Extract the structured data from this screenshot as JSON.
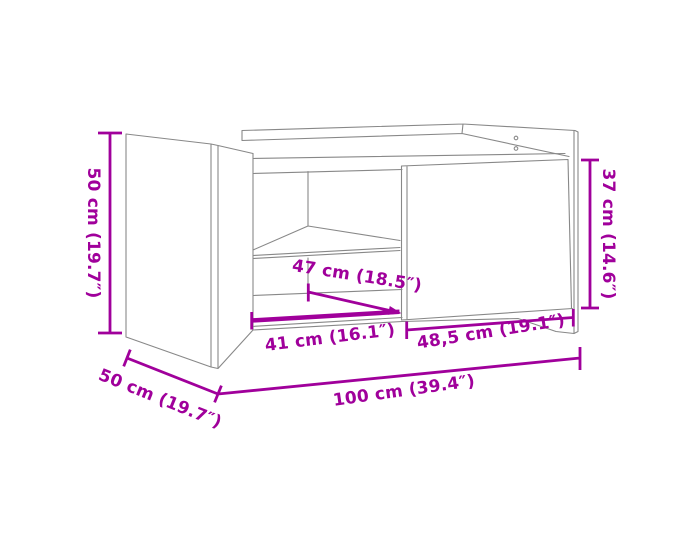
{
  "page": {
    "background_color": "#ffffff",
    "type": "product-dimension-diagram",
    "product": "coffee table line drawing"
  },
  "diagram": {
    "accent_color": "#A0009B",
    "outline_color": "#888888",
    "dimensions": {
      "height_left": "50 cm (19.7″)",
      "depth_bottom_left": "50 cm (19.7″)",
      "total_width": "100 cm (39.4″)",
      "inner_width": "41 cm (16.1″)",
      "inner_diagonal": "47 cm (18.5″)",
      "door_width": "48,5 cm (19.1″)",
      "door_height": "37 cm (14.6″)"
    }
  }
}
